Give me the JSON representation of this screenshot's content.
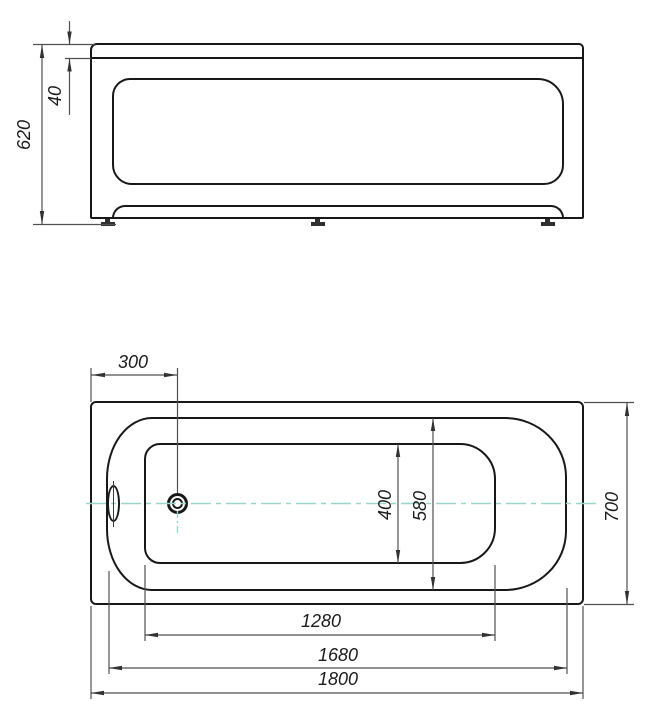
{
  "drawing": {
    "type": "bathtub-orthographic-drawing",
    "views": {
      "front": {
        "label": "front-elevation",
        "dims": {
          "overall_height": "620",
          "rim_thickness": "40"
        }
      },
      "plan": {
        "label": "top-plan",
        "dims": {
          "drain_offset": "300",
          "bottom_width": "400",
          "rim_inner_width": "580",
          "overall_width": "700",
          "bottom_length": "1280",
          "rim_inner_length": "1680",
          "overall_length": "1800"
        }
      }
    },
    "colors": {
      "outline": "#181818",
      "dimension_line": "#4f4f4f",
      "centerline": "#9ad6cc",
      "background": "#ffffff"
    }
  }
}
